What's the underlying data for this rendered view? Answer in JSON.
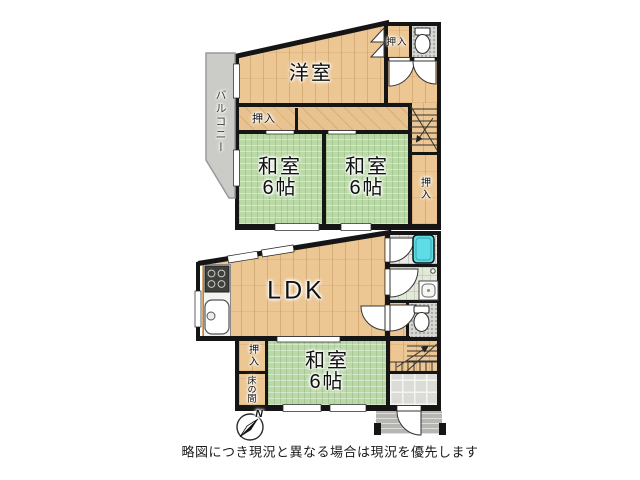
{
  "floor2": {
    "balcony": "バルコニー",
    "western_room": "洋室",
    "closet_top": "押入",
    "closet_hall": "押入",
    "closet_side": "押入",
    "japanese_room_left": {
      "name": "和室",
      "size": "6帖"
    },
    "japanese_room_right": {
      "name": "和室",
      "size": "6帖"
    }
  },
  "floor1": {
    "ldk": "LDK",
    "japanese_room": {
      "name": "和室",
      "size": "6帖"
    },
    "closet": "押入",
    "tokonoma": "床の間"
  },
  "compass": {
    "north": "N"
  },
  "footer": {
    "disclaimer": "略図につき現況と異なる場合は現況を優先します"
  },
  "colors": {
    "wall": "#151515",
    "wood": "#ecc794",
    "tatami": "#bad9a7",
    "balcony": "#cbcbc7",
    "bathtub": "#5ddde6",
    "toilet_tile": "#d8d8d4"
  }
}
